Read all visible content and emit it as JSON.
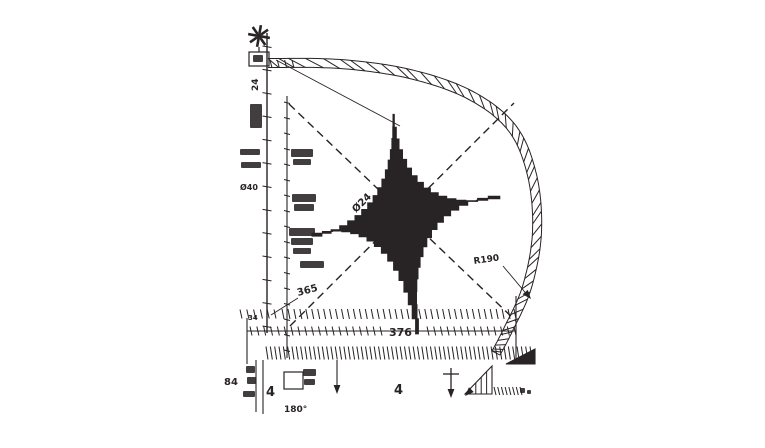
{
  "meta": {
    "title": "Four-point star mechanical part dimension drawing"
  },
  "colors": {
    "ink": "#282324",
    "bg": "#ffffff"
  },
  "icons": {
    "datum_flower": "eight-spoke-asterisk"
  },
  "annotations": [
    {
      "id": "dim-left-24",
      "text": "24",
      "x": 258,
      "y": 91,
      "rot": -90,
      "size": 9
    },
    {
      "id": "dim-dia-40",
      "text": "Ø40",
      "x": 240,
      "y": 190,
      "rot": 0,
      "size": 8
    },
    {
      "id": "dim-365",
      "text": "365",
      "x": 298,
      "y": 296,
      "rot": -15,
      "size": 10
    },
    {
      "id": "dim-34",
      "text": "34",
      "x": 248,
      "y": 320,
      "rot": 0,
      "size": 7
    },
    {
      "id": "dim-376",
      "text": "376",
      "x": 389,
      "y": 336,
      "rot": 0,
      "size": 11
    },
    {
      "id": "dim-center-dia24",
      "text": "Ø24",
      "x": 356,
      "y": 213,
      "rot": -45,
      "size": 10
    },
    {
      "id": "dim-r190",
      "text": "R190",
      "x": 474,
      "y": 264,
      "rot": -8,
      "size": 9
    },
    {
      "id": "dim-84",
      "text": "84",
      "x": 224,
      "y": 385,
      "rot": 0,
      "size": 10
    },
    {
      "id": "dim-180deg",
      "text": "180°",
      "x": 284,
      "y": 412,
      "rot": 0,
      "size": 9
    },
    {
      "id": "callout-4-left",
      "text": "4",
      "x": 266,
      "y": 396,
      "rot": 0,
      "size": 13
    },
    {
      "id": "callout-4-mid",
      "text": "4",
      "x": 394,
      "y": 394,
      "rot": 0,
      "size": 13
    }
  ],
  "drawing": {
    "canvas": {
      "w": 765,
      "h": 448
    },
    "star": {
      "cx": 402,
      "cy": 217,
      "tips": [
        {
          "a": 95,
          "r": 103
        },
        {
          "a": 12,
          "r": 100
        },
        {
          "a": 278,
          "r": 118
        },
        {
          "a": 192,
          "r": 92
        }
      ],
      "waists": [
        53.5,
        -35,
        235,
        143.5
      ],
      "waist_r": 36,
      "samples": 16
    },
    "centerlines": [
      {
        "id": "centerline-ne",
        "x1": 290,
        "y1": 326,
        "x2": 514,
        "y2": 103
      },
      {
        "id": "centerline-se",
        "x1": 289,
        "y1": 104,
        "x2": 516,
        "y2": 321
      }
    ],
    "band": {
      "id": "radius-arc-band",
      "points": [
        [
          268,
          63
        ],
        [
          340,
          64
        ],
        [
          410,
          74
        ],
        [
          470,
          95
        ],
        [
          512,
          128
        ],
        [
          532,
          175
        ],
        [
          537,
          232
        ],
        [
          527,
          287
        ],
        [
          508,
          330
        ],
        [
          496,
          353
        ]
      ],
      "half_width": 4.5,
      "ticks": 46
    },
    "lines": [
      {
        "id": "left-extension-line",
        "x1": 267,
        "y1": 33,
        "x2": 267,
        "y2": 333,
        "w": 1.4
      },
      {
        "id": "left-extension-line-2",
        "x1": 287,
        "y1": 96,
        "x2": 287,
        "y2": 358,
        "w": 1.1
      },
      {
        "id": "top-leader-line",
        "x1": 276,
        "y1": 60,
        "x2": 400,
        "y2": 126,
        "w": 0.9
      },
      {
        "id": "dim-376-baseline",
        "x1": 247,
        "y1": 331,
        "x2": 516,
        "y2": 331,
        "w": 1.1
      },
      {
        "id": "right-ext-vline",
        "x1": 516,
        "y1": 296,
        "x2": 516,
        "y2": 362,
        "w": 1.1
      },
      {
        "id": "left-ext-vline",
        "x1": 247,
        "y1": 318,
        "x2": 247,
        "y2": 364,
        "w": 1.1
      },
      {
        "id": "bottom-left-vline-1",
        "x1": 256,
        "y1": 360,
        "x2": 256,
        "y2": 412,
        "w": 1.1
      },
      {
        "id": "bottom-left-vline-2",
        "x1": 263,
        "y1": 360,
        "x2": 263,
        "y2": 414,
        "w": 1.1
      },
      {
        "id": "leader-t-stem",
        "x1": 451,
        "y1": 368,
        "x2": 451,
        "y2": 394,
        "w": 1.3
      },
      {
        "id": "leader-t-crossbar",
        "x1": 443,
        "y1": 374,
        "x2": 459,
        "y2": 374,
        "w": 1.3
      },
      {
        "id": "leader-337-stem",
        "x1": 337,
        "y1": 360,
        "x2": 337,
        "y2": 390,
        "w": 1.1
      },
      {
        "id": "dim-365-leader",
        "x1": 298,
        "y1": 298,
        "x2": 271,
        "y2": 315,
        "w": 0.9
      },
      {
        "id": "r190-leader",
        "x1": 503,
        "y1": 266,
        "x2": 529,
        "y2": 297,
        "w": 0.9
      },
      {
        "id": "flower-stem",
        "x1": 259,
        "y1": 47,
        "x2": 259,
        "y2": 52,
        "w": 1.2
      }
    ],
    "rects": [
      {
        "id": "datum-box",
        "x": 249,
        "y": 52,
        "w": 20,
        "h": 14
      },
      {
        "id": "callout-box-left",
        "x": 284,
        "y": 372,
        "w": 19,
        "h": 17
      }
    ],
    "tickbands": [
      {
        "id": "tick-band-a",
        "x": 282,
        "y": 314,
        "w": 232,
        "n": 40,
        "len": 10
      },
      {
        "id": "tick-band-a-stub",
        "x": 240,
        "y": 314,
        "w": 34,
        "n": 6,
        "len": 9
      },
      {
        "id": "tick-band-b-left",
        "x": 250,
        "y": 331,
        "w": 130,
        "n": 20,
        "len": 9
      },
      {
        "id": "tick-band-b-right",
        "x": 427,
        "y": 331,
        "w": 87,
        "n": 14,
        "len": 9
      },
      {
        "id": "tick-band-c",
        "x": 266,
        "y": 353,
        "w": 264,
        "n": 62,
        "len": 13
      },
      {
        "id": "tick-band-top",
        "x": 270,
        "y": 64,
        "w": 22,
        "n": 4,
        "len": 8
      },
      {
        "id": "tick-band-micro",
        "x": 494,
        "y": 391,
        "w": 26,
        "n": 8,
        "len": 8
      }
    ],
    "vtickgroups": [
      {
        "id": "ruler-ticks-main",
        "x": 267,
        "y": 46,
        "h": 280,
        "n": 13,
        "len": 9
      },
      {
        "id": "ruler-ticks-2",
        "x": 287,
        "y": 102,
        "h": 248,
        "n": 17,
        "len": 6
      }
    ],
    "arrows": [
      {
        "id": "arrow-r190",
        "x": 531,
        "y": 299,
        "ang": 50
      },
      {
        "id": "arrow-leader-t",
        "x": 451,
        "y": 398,
        "ang": 90
      },
      {
        "id": "arrow-337",
        "x": 337,
        "y": 394,
        "ang": 90
      },
      {
        "id": "arrow-hatch-tri",
        "x": 465,
        "y": 396,
        "ang": 135
      }
    ],
    "polys": [
      {
        "id": "end-wedge",
        "pts": [
          [
            506,
            364
          ],
          [
            535,
            349
          ],
          [
            535,
            364
          ]
        ],
        "fill": true
      },
      {
        "id": "hatch-triangle",
        "pts": [
          [
            465,
            394
          ],
          [
            492,
            366
          ],
          [
            492,
            394
          ]
        ],
        "fill": false,
        "hatch": 4
      }
    ],
    "blobs": [
      [
        291,
        149,
        22,
        8
      ],
      [
        293,
        159,
        18,
        6
      ],
      [
        292,
        194,
        24,
        8
      ],
      [
        294,
        204,
        20,
        7
      ],
      [
        289,
        228,
        26,
        8
      ],
      [
        291,
        238,
        22,
        7
      ],
      [
        293,
        248,
        18,
        6
      ],
      [
        300,
        261,
        24,
        7
      ],
      [
        240,
        149,
        20,
        6
      ],
      [
        241,
        162,
        20,
        6
      ],
      [
        250,
        104,
        12,
        24
      ],
      [
        253,
        55,
        10,
        7
      ],
      [
        246,
        366,
        9,
        7
      ],
      [
        247,
        377,
        9,
        7
      ],
      [
        243,
        391,
        12,
        6
      ],
      [
        303,
        369,
        13,
        7
      ],
      [
        304,
        379,
        11,
        6
      ],
      [
        520,
        388,
        5,
        5
      ],
      [
        527,
        390,
        4,
        4
      ]
    ],
    "flower": {
      "x": 259,
      "y": 36,
      "r": 11,
      "spokes": 8
    }
  }
}
